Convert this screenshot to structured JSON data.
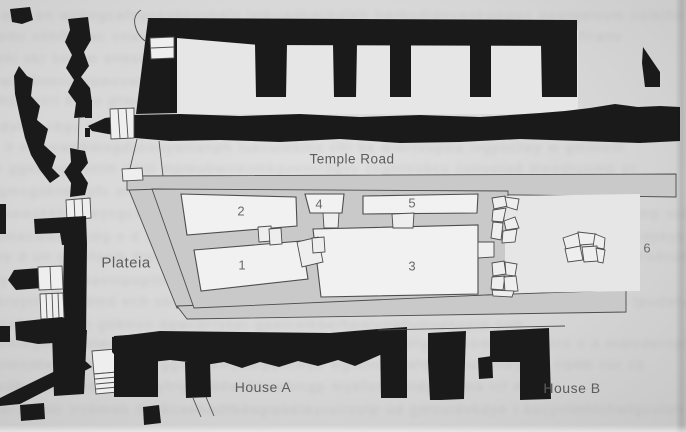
{
  "figure": {
    "kind": "scanned archaeological site plan",
    "labels": {
      "temple_road": "Temple Road",
      "plateia": "Plateia",
      "house_a": "House A",
      "house_b": "House B"
    },
    "rooms": [
      {
        "label": "1"
      },
      {
        "label": "2"
      },
      {
        "label": "3"
      },
      {
        "label": "4"
      },
      {
        "label": "5"
      },
      {
        "label": "6"
      }
    ]
  },
  "colors": {
    "ink": "#1a1a1a",
    "stone": "#c9c9c9",
    "room": "#f1f1f1",
    "paper": "#eeeeee",
    "paper2": "#e6e6e6",
    "bg": "#d7d7d7",
    "line": "#4d4d4d",
    "label": "#5c5c5c"
  }
}
